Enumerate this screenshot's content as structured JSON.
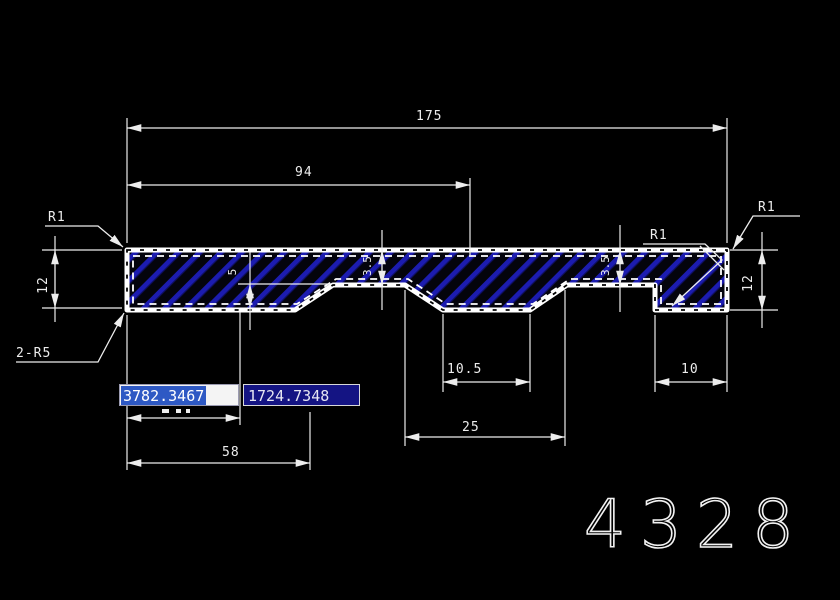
{
  "canvas": {
    "width": 840,
    "height": 600,
    "background": "#000000"
  },
  "drawing": {
    "sheet_number": "4328",
    "labels": {
      "fillet_top_left": "R1",
      "fillet_mid_right": "R1",
      "fillet_top_right": "R1",
      "corner_note": "2-R5"
    },
    "dims": {
      "total_length": "175",
      "upper_length": "94",
      "left_height": "12",
      "right_height": "12",
      "step_depth": "5",
      "web_mid": "3.5",
      "web_right": "3.5",
      "notch_width_top": "10.5",
      "notch_width_bottom": "25",
      "tab_width": "10",
      "left_segment": "58"
    },
    "colors": {
      "outline": "#ffffff",
      "hatch": "#1c1cb0",
      "dim_lines": "#ededed",
      "selection": "#2e59c4",
      "field_background": "#141483"
    }
  },
  "coordinate_input": {
    "x_field": {
      "value": "3782.3467",
      "state": "selected"
    },
    "y_field": {
      "value": "1724.7348"
    }
  }
}
